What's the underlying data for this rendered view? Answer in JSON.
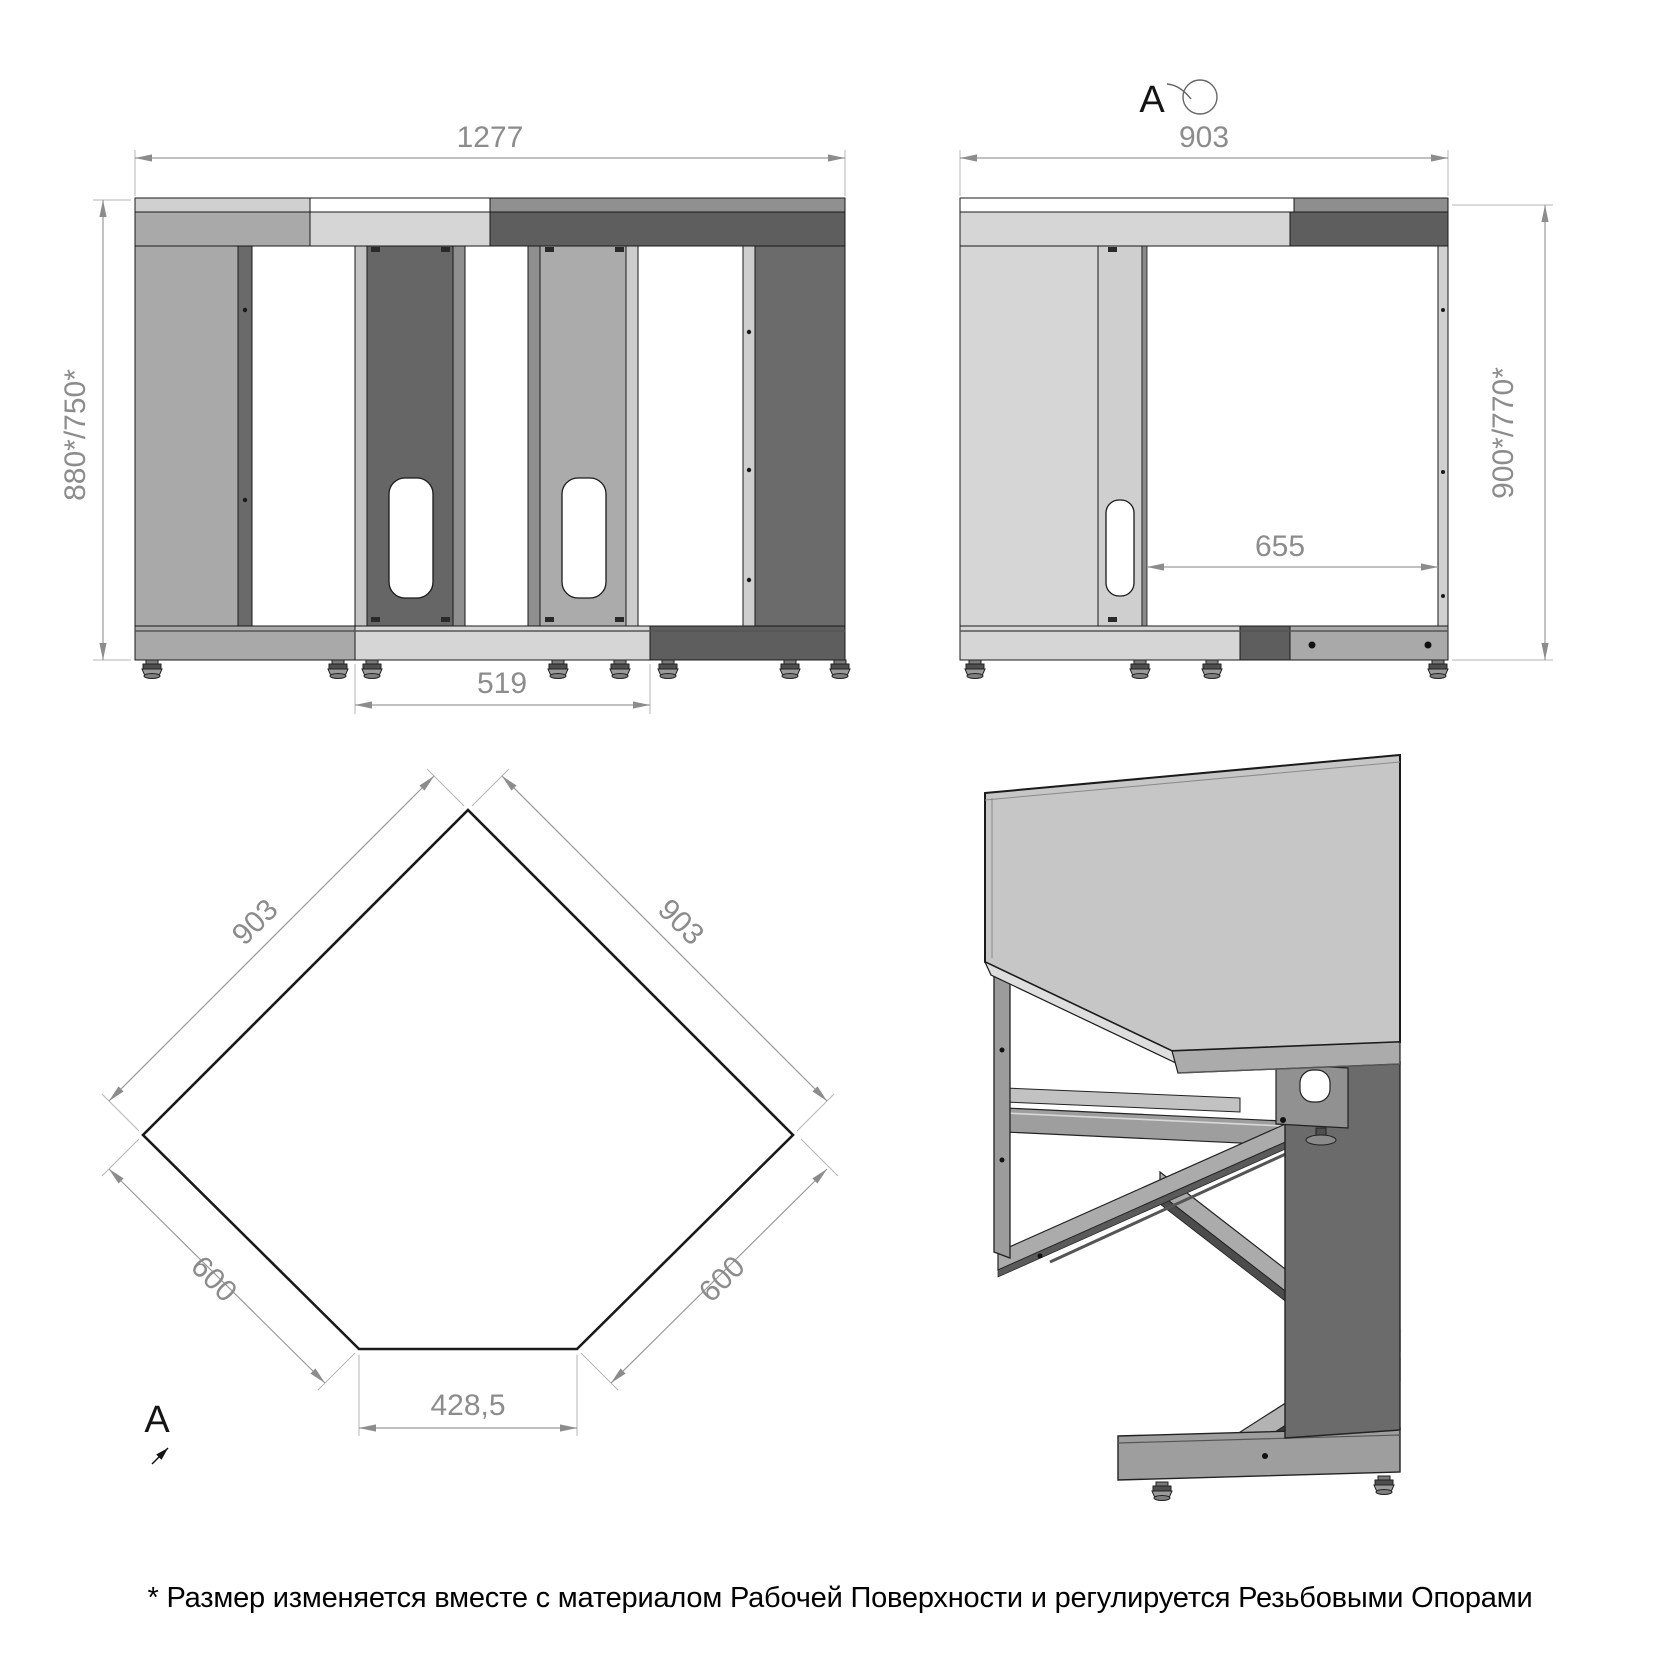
{
  "note": "* Размер изменяется вместе с материалом Рабочей Поверхности и регулируется Резьбовыми Опорами",
  "views": {
    "front": {
      "dim_width": "1277",
      "dim_height": "880*/750*",
      "dim_base_width": "519"
    },
    "side": {
      "detail_marker": "A",
      "dim_width": "903",
      "dim_height": "900*/770*",
      "dim_inner_width": "655"
    },
    "plan": {
      "detail_marker": "A",
      "dim_edge_upper_left": "903",
      "dim_edge_upper_right": "903",
      "dim_edge_lower_left": "600",
      "dim_edge_lower_right": "600",
      "dim_edge_bottom": "428,5"
    }
  },
  "colors": {
    "outline": "#1a1a1a",
    "dim_line": "#9a9a9a",
    "dim_text": "#8c8c8c",
    "panel_light": "#d6d6d6",
    "panel_medium": "#a9a9a9",
    "panel_dark": "#5e5e5e",
    "panel_dark2": "#6a6a6a",
    "background": "#ffffff"
  }
}
